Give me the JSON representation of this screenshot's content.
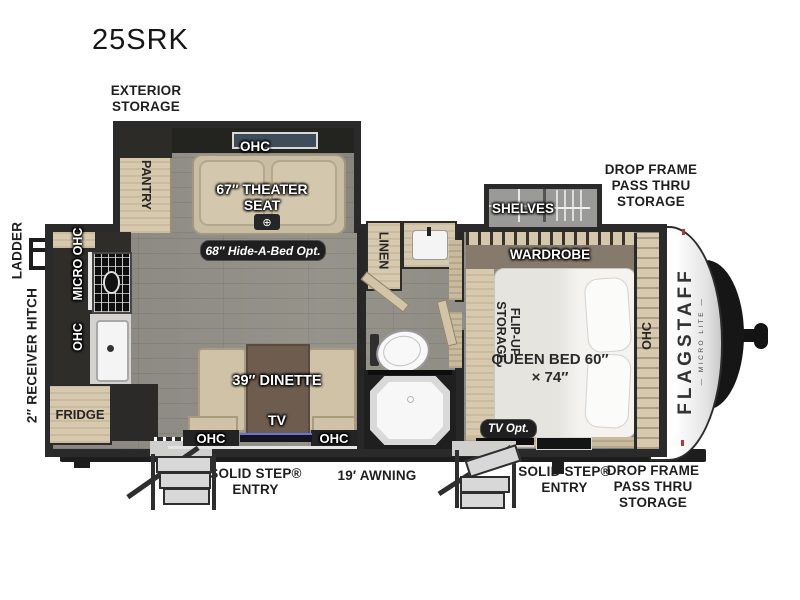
{
  "model": "25SRK",
  "brand": {
    "name": "FLAGSTAFF",
    "sub": "— MICRO LITE —"
  },
  "exterior": {
    "exterior_storage": "EXTERIOR STORAGE",
    "ladder": "LADDER",
    "receiver_hitch": "2″ RECEIVER HITCH",
    "drop_frame_front": "DROP FRAME PASS THRU STORAGE",
    "drop_frame_rear": "DROP FRAME PASS THRU STORAGE",
    "solid_step_left": "SOLID STEP® ENTRY",
    "solid_step_right": "SOLID STEP® ENTRY",
    "awning": "19′ AWNING"
  },
  "rooms": {
    "pantry": "PANTRY",
    "slide_ohc": "OHC",
    "theater_seat": "67″ THEATER SEAT",
    "hide_a_bed": "68″ Hide-A-Bed Opt.",
    "micro_ohc": "MICRO OHC",
    "kitchen_ohc": "OHC",
    "fridge": "FRIDGE",
    "dinette": "39″ DINETTE",
    "tv": "TV",
    "dinette_ohc_left": "OHC",
    "dinette_ohc_right": "OHC",
    "linen": "LINEN",
    "shelves": "SHELVES",
    "wardrobe": "WARDROBE",
    "flip_up_storage": "FLIP-UP STORAGE",
    "queen_bed": "QUEEN BED 60″ × 74″",
    "bed_ohc": "OHC",
    "tv_opt": "TV Opt."
  },
  "icons": {
    "cupholder": "⊕"
  },
  "colors": {
    "wall": "#2a2a2a",
    "floor": "#8e8c87",
    "wood": "#d7c9ad",
    "seat_tan": "#c9bda3",
    "table_brown": "#6e5c4e",
    "badge_dark": "#1f1f1f",
    "cap_white": "#f2f2f2",
    "marker_red": "#b23a33"
  }
}
